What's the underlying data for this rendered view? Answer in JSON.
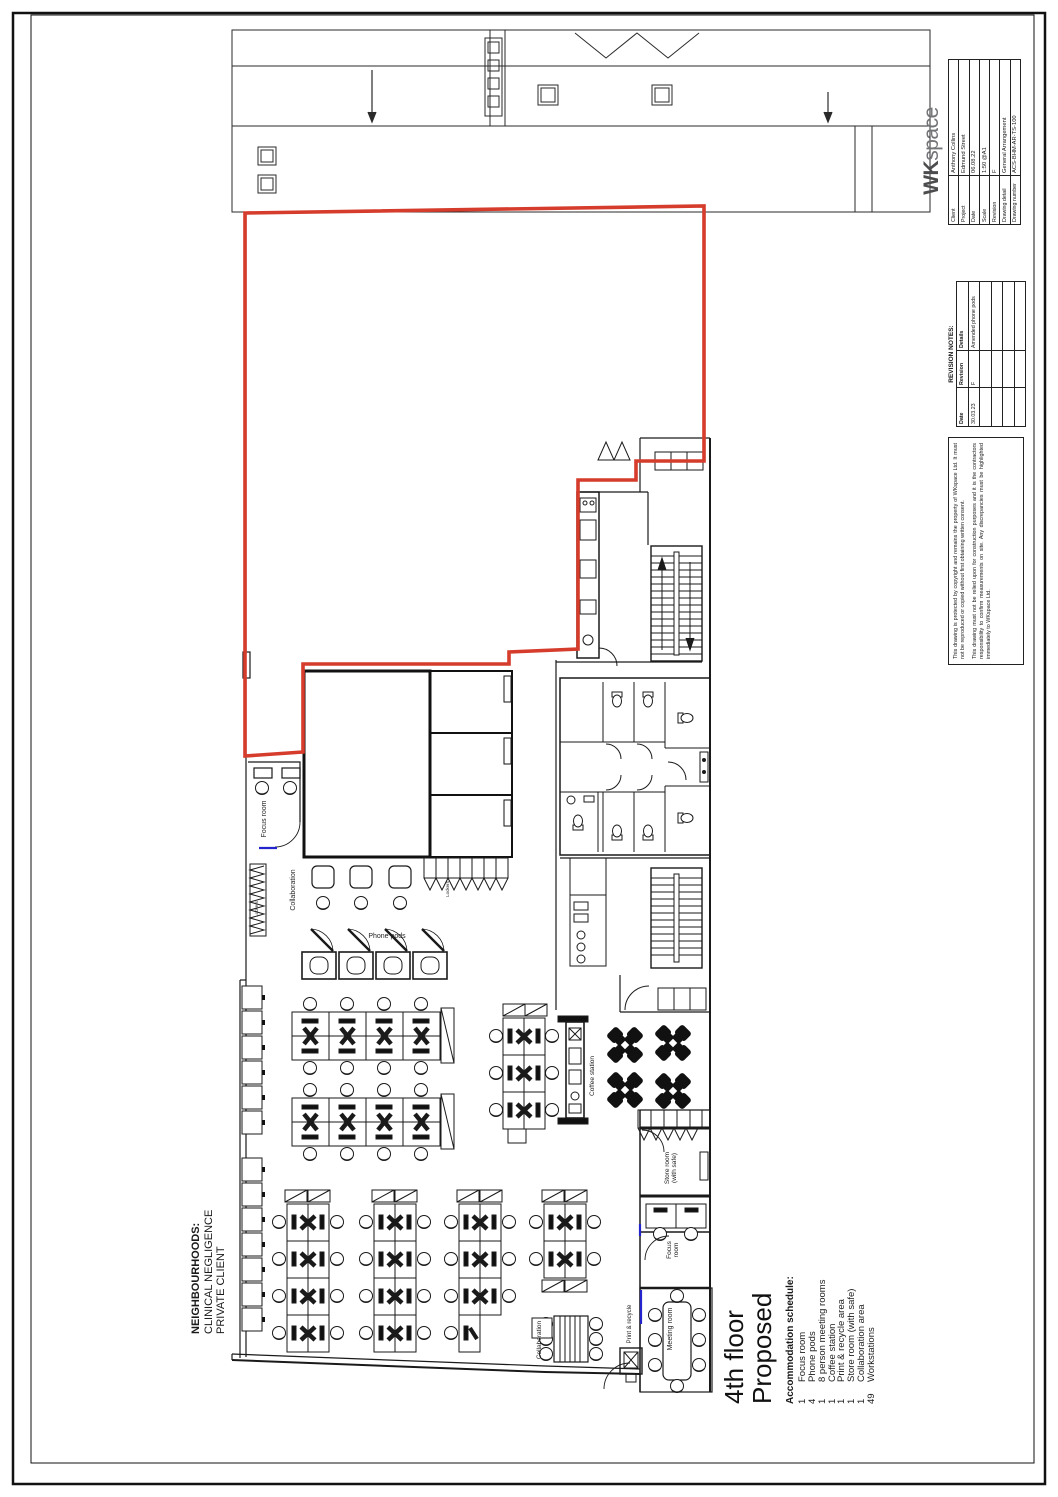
{
  "title_block": {
    "logo": {
      "wk": "WK",
      "space": "space"
    },
    "fields": [
      {
        "label": "Client",
        "value": "Anthony Collins"
      },
      {
        "label": "Project",
        "value": "Edmund Street"
      },
      {
        "label": "Date",
        "value": "06.08.22"
      },
      {
        "label": "Scale",
        "value": "1:50 @A1"
      },
      {
        "label": "Revision",
        "value": "F"
      },
      {
        "label": "Drawing detail",
        "value": "General Arrangement"
      },
      {
        "label": "Drawing number",
        "value": "ACS-BHM-AR-TS-100"
      }
    ],
    "revision_notes": {
      "title": "REVISION NOTES:",
      "headers": {
        "date": "Date",
        "revision": "Revision",
        "details": "Details"
      },
      "rows": [
        {
          "date": "30.03.23",
          "revision": "F",
          "details": "Amended phone pods"
        }
      ]
    },
    "copyright": {
      "para1": "This drawing is protected by copyright and remains the property of WKspace Ltd. It must not be reproduced or copied without first obtaining written consent.",
      "para2": "This drawing must not be relied upon for construction purposes and it is the contractors responsibility to confirm measurements on site. Any discrepancies must be highlighted immediately to WKspace Ltd."
    }
  },
  "drawing": {
    "floor_title": "4th floor",
    "status_title": "Proposed",
    "schedule": {
      "heading": "Accommodation schedule:",
      "items": [
        {
          "qty": "1",
          "label": "Focus room"
        },
        {
          "qty": "4",
          "label": "Phone pods"
        },
        {
          "qty": "1",
          "label": "8 person meeting rooms"
        },
        {
          "qty": "1",
          "label": "Coffee station"
        },
        {
          "qty": "1",
          "label": "Print & recycle area"
        },
        {
          "qty": "1",
          "label": "Store room (with safe)"
        },
        {
          "qty": "1",
          "label": "Collaboration area"
        },
        {
          "qty": "49",
          "label": "Workstations"
        }
      ]
    },
    "neighbourhoods": {
      "heading": "NEIGHBOURHOODS:",
      "lines": [
        "CLINICAL NEGLIGENCE",
        "PRIVATE CLIENT"
      ]
    },
    "plan_labels": {
      "focus_room_top": "Focus room",
      "collaboration_top": "Collaboration",
      "lockers_left": "Lockers",
      "lockers_mid": "Lockers",
      "phone_pods": "Phone pods",
      "coffee_station": "Coffee station",
      "store_room": "Store room (with safe)",
      "focus_room_bottom": "Focus room",
      "meeting_room": "Meeting room",
      "print_recycle": "Print & recycle",
      "collaboration_bottom": "Collaboration"
    },
    "colors": {
      "demise_red": "#d63c2c",
      "glazing_blue": "#2424cc"
    }
  }
}
